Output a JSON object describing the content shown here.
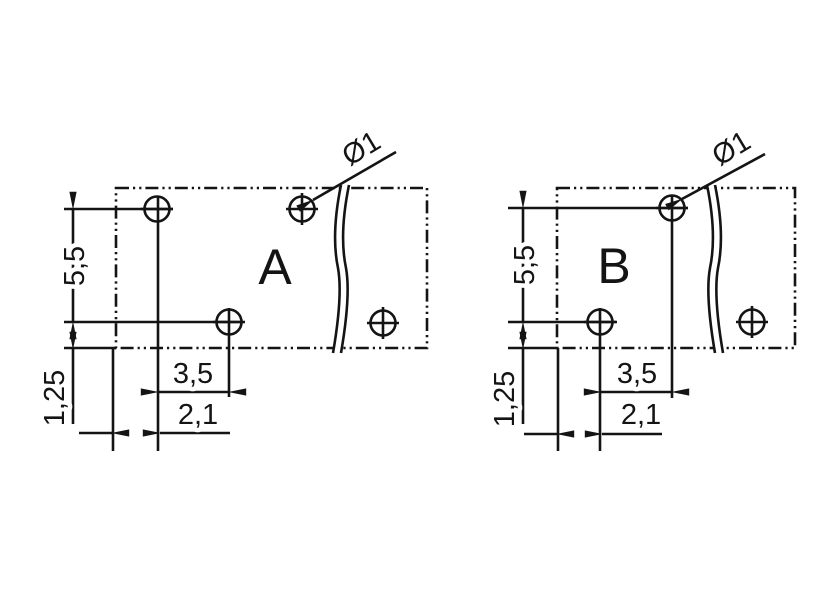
{
  "drawing": {
    "type": "technical-drilling-plan",
    "background_color": "#ffffff",
    "line_color": "#141414",
    "panels": [
      {
        "name": "A",
        "hole_diameter_label": "Ø1",
        "vertical_pitch_label": "5,5",
        "edge_offset_label": "1,25",
        "horizontal_pitch_label": "3,5",
        "edge_to_first_hole_label": "2,1"
      },
      {
        "name": "B",
        "hole_diameter_label": "Ø1",
        "vertical_pitch_label": "5,5",
        "edge_offset_label": "1,25",
        "horizontal_pitch_label": "3,5",
        "edge_to_first_hole_label": "2,1"
      }
    ]
  }
}
